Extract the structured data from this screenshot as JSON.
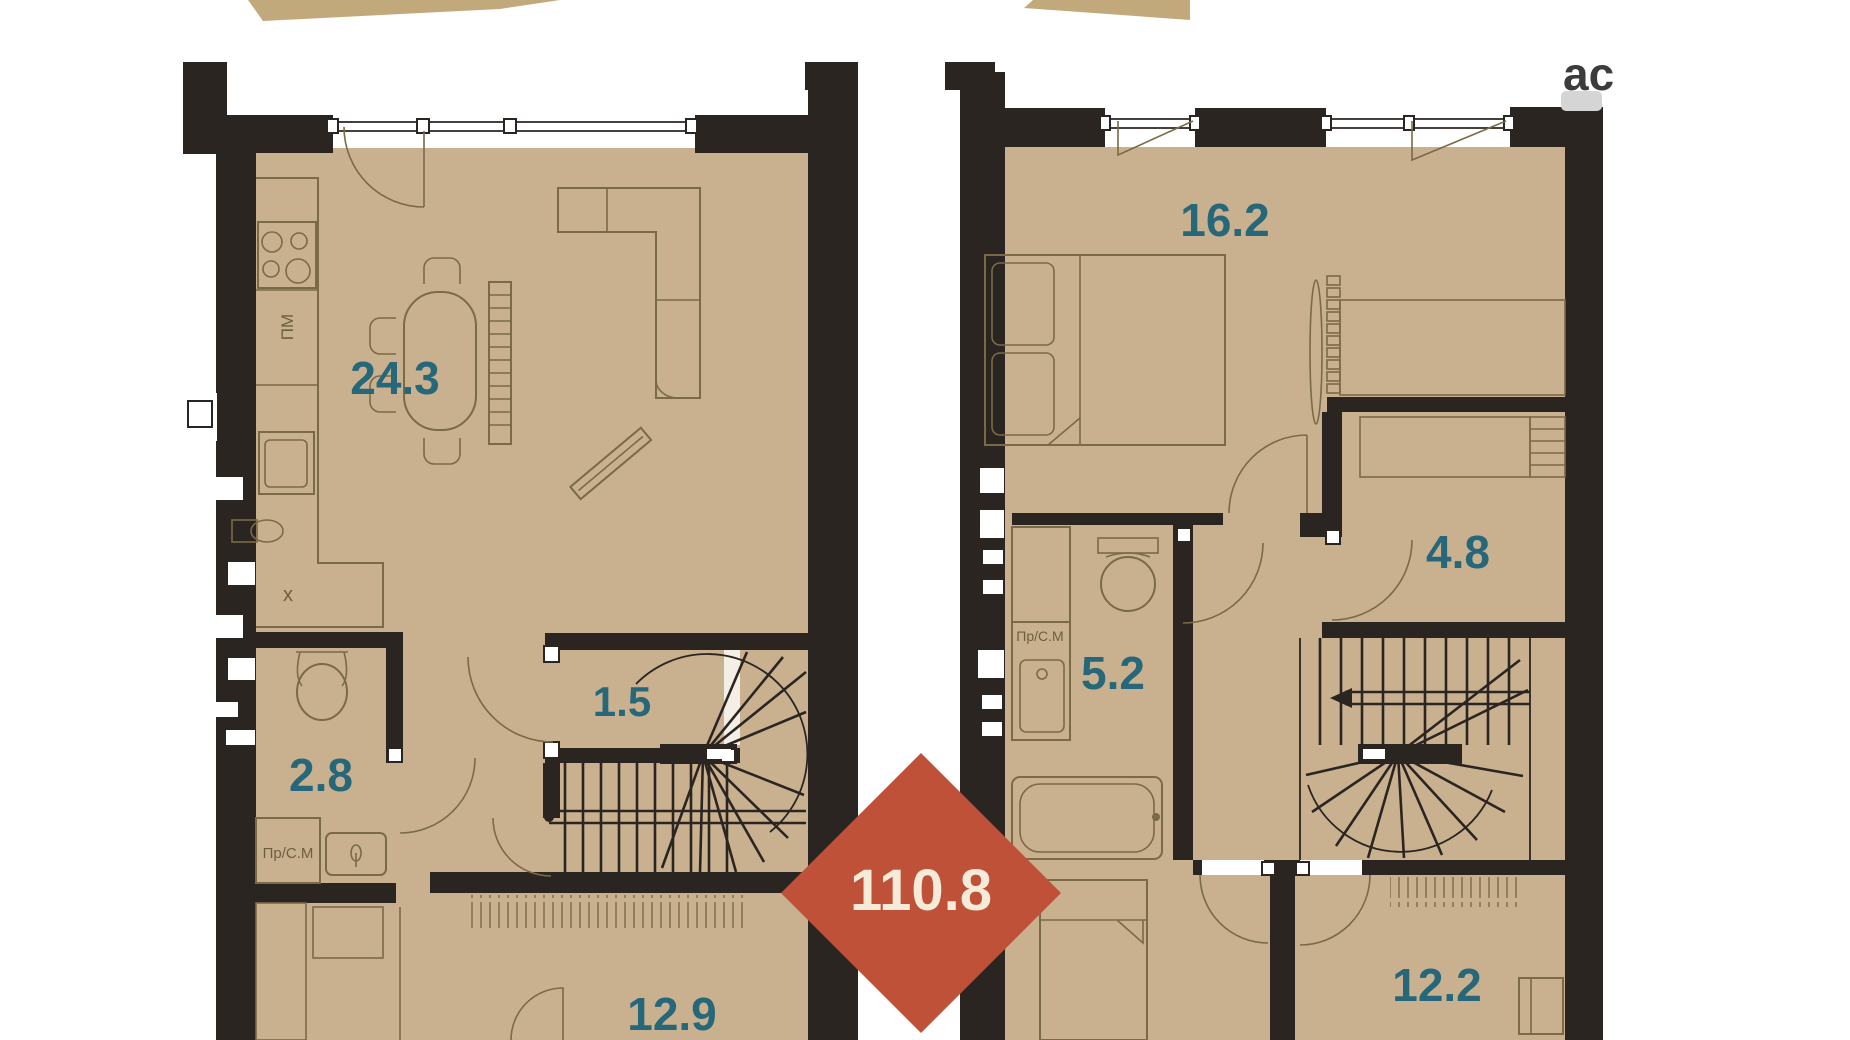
{
  "watermark": {
    "text": "ас"
  },
  "total_badge": {
    "area": "110.8",
    "shape": "diamond"
  },
  "palette": {
    "wall": "#2b2522",
    "floor": "#c9b190",
    "furniture_line": "#7a6a45",
    "room_label": "#266879",
    "badge": "#bf5138",
    "badge_text": "#f6ead8",
    "banner": "#c2a97b",
    "watermark_bg": "#d5d5d5",
    "watermark_text": "#3c3c3c"
  },
  "floor1": {
    "rooms": [
      {
        "name": "kitchen-living-room",
        "area": "24.3"
      },
      {
        "name": "bathroom",
        "area": "2.8"
      },
      {
        "name": "hallway",
        "area": "1.5"
      },
      {
        "name": "room",
        "area": "12.9"
      }
    ],
    "fixtures": {
      "dishwasher": "ПМ",
      "washing_machine": "Пр/С.М",
      "sink_mark": "x"
    }
  },
  "floor2": {
    "rooms": [
      {
        "name": "bedroom",
        "area": "16.2"
      },
      {
        "name": "dressing-room",
        "area": "4.8"
      },
      {
        "name": "bathroom",
        "area": "5.2"
      },
      {
        "name": "room",
        "area": "12.2"
      }
    ],
    "fixtures": {
      "washing_machine": "Пр/С.М"
    }
  }
}
